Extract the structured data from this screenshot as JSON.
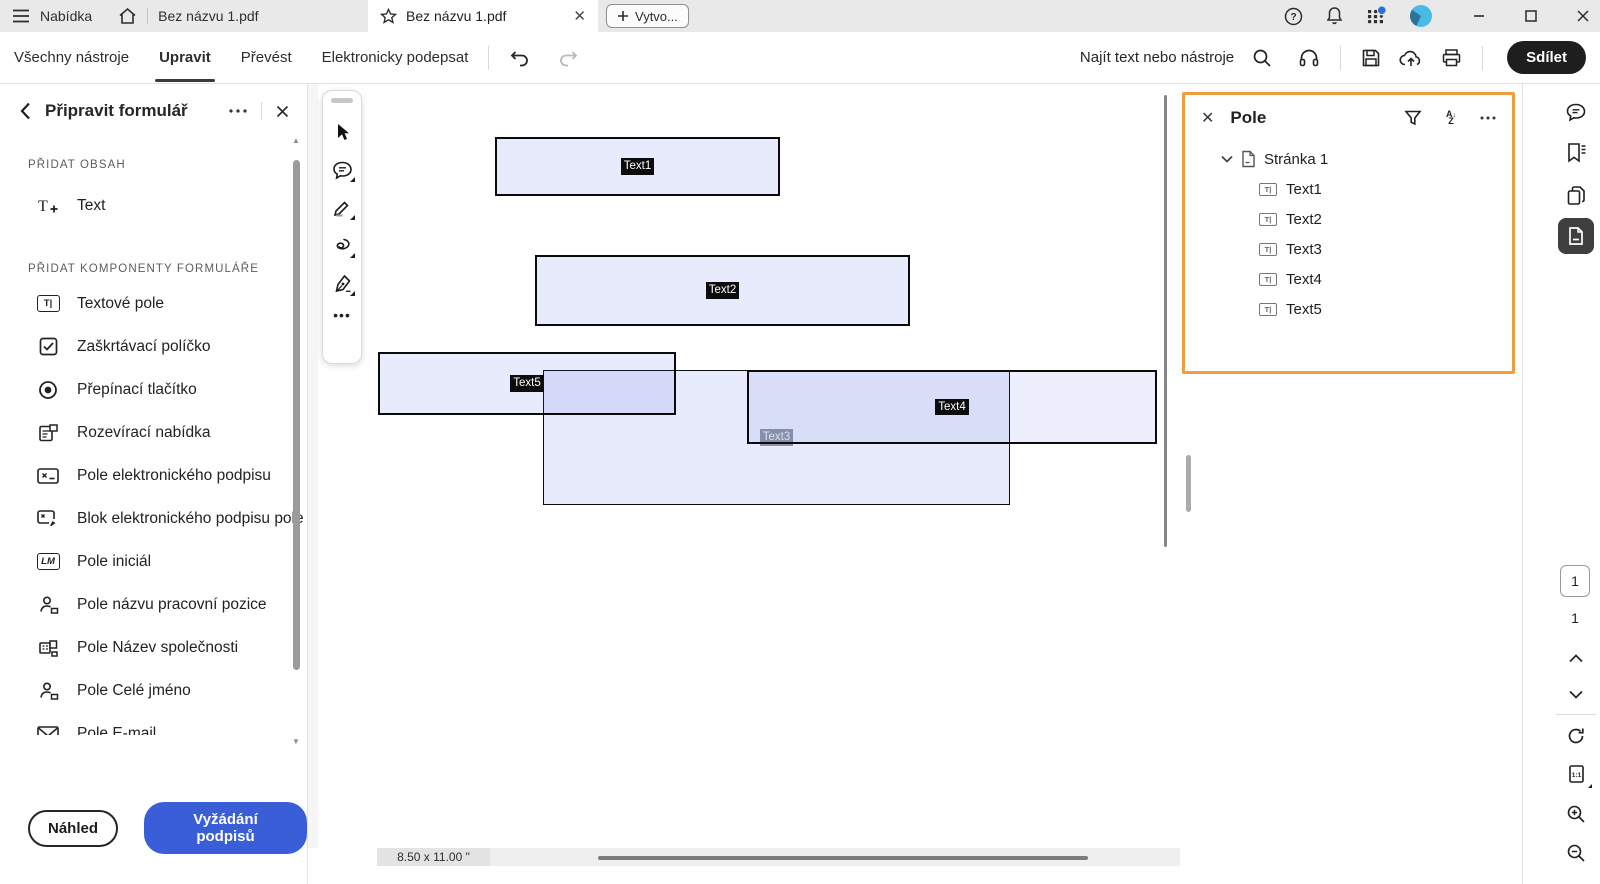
{
  "titlebar": {
    "menu_label": "Nabídka",
    "recent_doc_title": "Bez názvu 1.pdf",
    "tab_title": "Bez názvu 1.pdf",
    "create_button": "Vytvo...",
    "icons": [
      "hamburger-icon",
      "home-icon",
      "star-icon",
      "close-icon",
      "plus-icon",
      "help-icon",
      "bell-icon",
      "apps-grid-icon",
      "avatar",
      "minimize-icon",
      "maximize-icon",
      "window-close-icon"
    ]
  },
  "toolbar": {
    "tab_all_tools": "Všechny nástroje",
    "tab_edit": "Upravit",
    "tab_convert": "Převést",
    "tab_esign": "Elektronicky podepsat",
    "active_tab": "Upravit",
    "search_label": "Najít text nebo nástroje",
    "share_button": "Sdílet",
    "icons": [
      "undo-icon",
      "redo-icon",
      "search-icon",
      "headphones-icon",
      "save-icon",
      "cloud-upload-icon",
      "print-icon"
    ]
  },
  "sidebar": {
    "title": "Připravit formulář",
    "section_add_content": "PŘIDAT OBSAH",
    "text_tool_label": "Text",
    "section_components": "PŘIDAT KOMPONENTY FORMULÁŘE",
    "components": [
      {
        "icon": "textfield-icon",
        "label": "Textové pole"
      },
      {
        "icon": "checkbox-icon",
        "label": "Zaškrtávací políčko"
      },
      {
        "icon": "radio-icon",
        "label": "Přepínací tlačítko"
      },
      {
        "icon": "dropdown-icon",
        "label": "Rozevírací nabídka"
      },
      {
        "icon": "signature-field-icon",
        "label": "Pole elektronického podpisu"
      },
      {
        "icon": "signature-block-icon",
        "label": "Blok elektronického podpisu pole"
      },
      {
        "icon": "initials-icon",
        "label": "Pole iniciál"
      },
      {
        "icon": "person-icon",
        "label": "Pole názvu pracovní pozice"
      },
      {
        "icon": "company-icon",
        "label": "Pole Název společnosti"
      },
      {
        "icon": "person-icon",
        "label": "Pole Celé jméno"
      },
      {
        "icon": "email-icon",
        "label": "Pole E-mail"
      }
    ],
    "preview_button": "Náhled",
    "request_signatures_button": "Vyžádání podpisů"
  },
  "palette": {
    "tools": [
      "select-tool",
      "comment-tool",
      "draw-tool",
      "lasso-tool",
      "sign-tool",
      "more-tools"
    ]
  },
  "canvas": {
    "fields": [
      {
        "name": "Text1"
      },
      {
        "name": "Text2"
      },
      {
        "name": "Text3"
      },
      {
        "name": "Text4"
      },
      {
        "name": "Text5"
      }
    ],
    "page_size_label": "8.50 x 11.00 \""
  },
  "fields_panel": {
    "title": "Pole",
    "page_group_label": "Stránka 1",
    "items": [
      "Text1",
      "Text2",
      "Text3",
      "Text4",
      "Text5"
    ],
    "icons": [
      "filter-funnel-icon",
      "sort-az-icon",
      "ellipsis-icon",
      "chevron-down-icon",
      "page-icon"
    ]
  },
  "right_rail": {
    "current_page": "1",
    "total_pages": "1",
    "icons": [
      "comment-icon",
      "bookmark-icon",
      "copy-pages-icon",
      "page-thumbnails-icon",
      "chevron-up-icon",
      "chevron-down-icon",
      "rotate-icon",
      "actual-size-icon",
      "zoom-in-icon",
      "zoom-out-icon"
    ]
  },
  "colors": {
    "panel_accent_orange": "#F09D3D",
    "primary_blue": "#3A5ED8",
    "field_fill_blue": "#526CDE",
    "titlebar_gray": "#E9E9EA"
  }
}
